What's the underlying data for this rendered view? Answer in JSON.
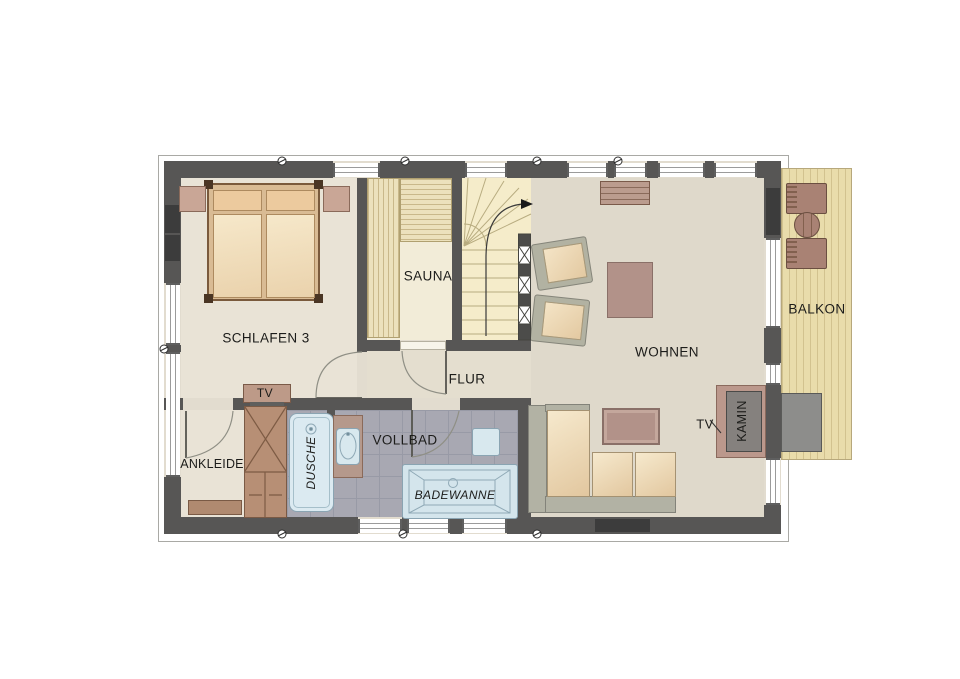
{
  "rooms": {
    "schlafen3": "SCHLAFEN 3",
    "sauna": "SAUNA",
    "flur": "FLUR",
    "wohnen": "WOHNEN",
    "balkon": "BALKON",
    "ankleide": "ANKLEIDE",
    "dusche": "DUSCHE",
    "vollbad": "VOLLBAD"
  },
  "fixtures": {
    "badewanne": "BADEWANNE",
    "kamin": "KAMIN",
    "tv_schlafen": "TV",
    "tv_wohnen": "TV"
  },
  "colors": {
    "wall": "#575655",
    "floor_main": "#e2dccf",
    "floor_bedroom": "#e9e3d6",
    "floor_wohnen": "#dfd9cb",
    "tile_bath": "#a8a8b2",
    "sauna_floor": "#f2ecd8",
    "stairs_floor": "#f5ecca",
    "balcony_deck": "#e9dcab",
    "fixture_blue": "#d8e8ee",
    "wood_furniture": "#bb9a8a",
    "mattress": "#f0dcba"
  }
}
